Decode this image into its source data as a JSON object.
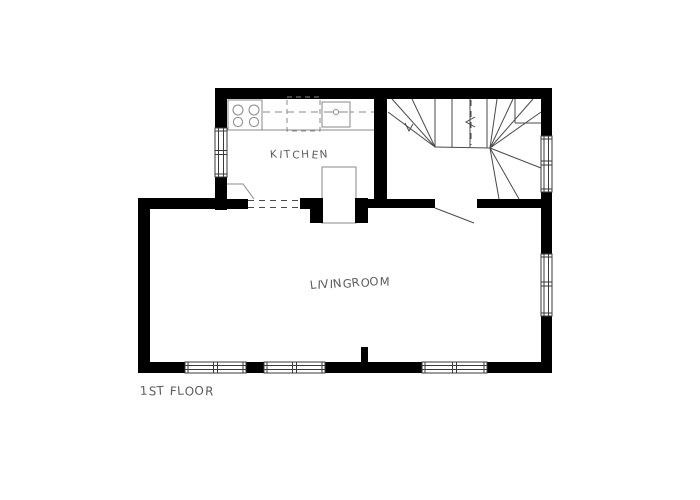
{
  "labels": {
    "kitchen": "KITCHEN",
    "livingroom": "LIVINGROOM",
    "floor_title": "1ST FLOOR"
  },
  "colors": {
    "wall": "#000000",
    "line": "#4a4a4a",
    "fixture_line": "#8a8a8a",
    "label_text": "#5c5c5c"
  },
  "diagram_data": {
    "type": "floor-plan",
    "floor": "1ST FLOOR",
    "style": "hand-drafted black-and-white architectural plan",
    "rooms": [
      {
        "name": "kitchen",
        "label": "KITCHEN",
        "position": "top-left",
        "fixtures": [
          "counter-along-north-wall",
          "stove-4-burners",
          "sink-with-drain",
          "upper-cabinet-dashed",
          "corner-cabinet-angled",
          "chimney-stove-box"
        ],
        "openings": [
          "window-west-wall",
          "cased-opening-dashed-to-livingroom"
        ]
      },
      {
        "name": "stair-hall",
        "label": "",
        "position": "top-right",
        "fixtures": [
          "u-shaped-winder-staircase",
          "walk-line-dashed-with-arrow"
        ],
        "openings": [
          "window-east-wall",
          "door-to-livingroom"
        ]
      },
      {
        "name": "livingroom",
        "label": "LIVINGROOM",
        "position": "bottom",
        "fixtures": [
          "fireplace-chimney-with-two-piers",
          "wall-stub-south"
        ],
        "openings": [
          "three-windows-south-wall",
          "window-east-wall",
          "cased-opening-to-kitchen",
          "door-to-stair-hall"
        ]
      }
    ],
    "window_count": 6,
    "door_count": 1
  }
}
